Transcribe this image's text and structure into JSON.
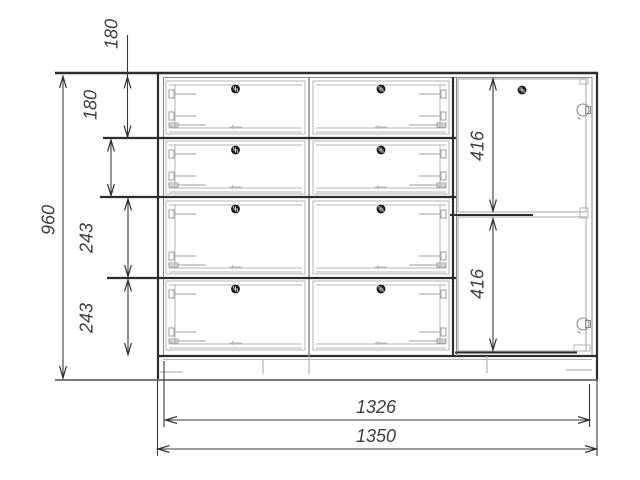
{
  "dimensions": {
    "overall_height": "960",
    "top_drawer_height": "180",
    "second_drawer_height": "180",
    "third_drawer_height": "243",
    "bottom_drawer_height": "243",
    "upper_door_height": "416",
    "lower_door_height": "416",
    "inner_width": "1326",
    "overall_width": "1350"
  },
  "icons": {
    "knob": "screw-knob-icon",
    "hinge": "door-hinge-icon"
  },
  "colors": {
    "background": "#ffffff",
    "line_dark": "#2d2d2d",
    "line_medium": "#8a8a8a",
    "line_light": "#b5b5b5",
    "dim_text": "#3e3e3e"
  }
}
